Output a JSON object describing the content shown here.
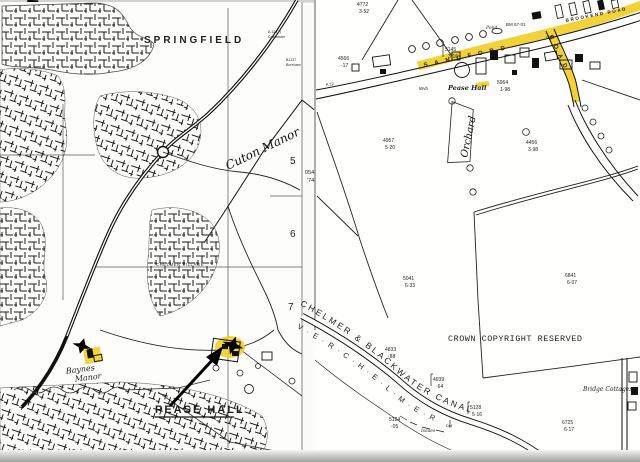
{
  "map": {
    "left": {
      "springfield": "SPRINGFIELD",
      "chelmer_village": "CHELMER VILLAGE",
      "pease_hall": "PEASE HALL",
      "sign_a12_line1": "A.12 (T)",
      "sign_a12_line2": "Colchester",
      "sign_b1137_line1": "B1137",
      "sign_b1137_line2": "Boreham",
      "grid_5": "5",
      "grid_6": "6",
      "grid_7": "7",
      "edge_num_1": "054",
      "edge_num_2": "'74",
      "handwriting_cuton": "Cuton Manor",
      "handwriting_baynes_1": "Baynes",
      "handwriting_baynes_2": "Manor"
    },
    "right": {
      "sandford_road": "SANDFORD",
      "road_word": "ROAD",
      "brookend_road": "BROOKEND ROAD",
      "a12": "A 12",
      "pease_hall": "Pease Hall",
      "pond": "Pond",
      "bm": "BM 67·01",
      "gp": "G.P",
      "wvh": "Wvh",
      "orchard": "Orchard",
      "canal_name": "CHELMER & BLACKWATER CANAL",
      "river_name": "V · E · R ·  C · H · E · L · M · E · R",
      "crown": "CROWN COPYRIGHT RESERVED",
      "bridge_cottages": "Bridge Cottages",
      "issues": "Issues",
      "def": "Def",
      "highlight_color": "#f2cf2a",
      "parcels": [
        {
          "id": "4772",
          "area": "3·52"
        },
        {
          "id": "4566",
          "area": "·17"
        },
        {
          "id": "5145",
          "area": "3·16"
        },
        {
          "id": "5964",
          "area": "1·98"
        },
        {
          "id": "4957",
          "area": "5·20"
        },
        {
          "id": "4456",
          "area": "3·98"
        },
        {
          "id": "5041",
          "area": "6·33"
        },
        {
          "id": "6841",
          "area": "6·07"
        },
        {
          "id": "4833",
          "area": "·88"
        },
        {
          "id": "4939",
          "area": "·64"
        },
        {
          "id": "5128",
          "area": "5·16"
        },
        {
          "id": "5124",
          "area": "·05"
        },
        {
          "id": "6725",
          "area": "6·17"
        }
      ]
    }
  }
}
